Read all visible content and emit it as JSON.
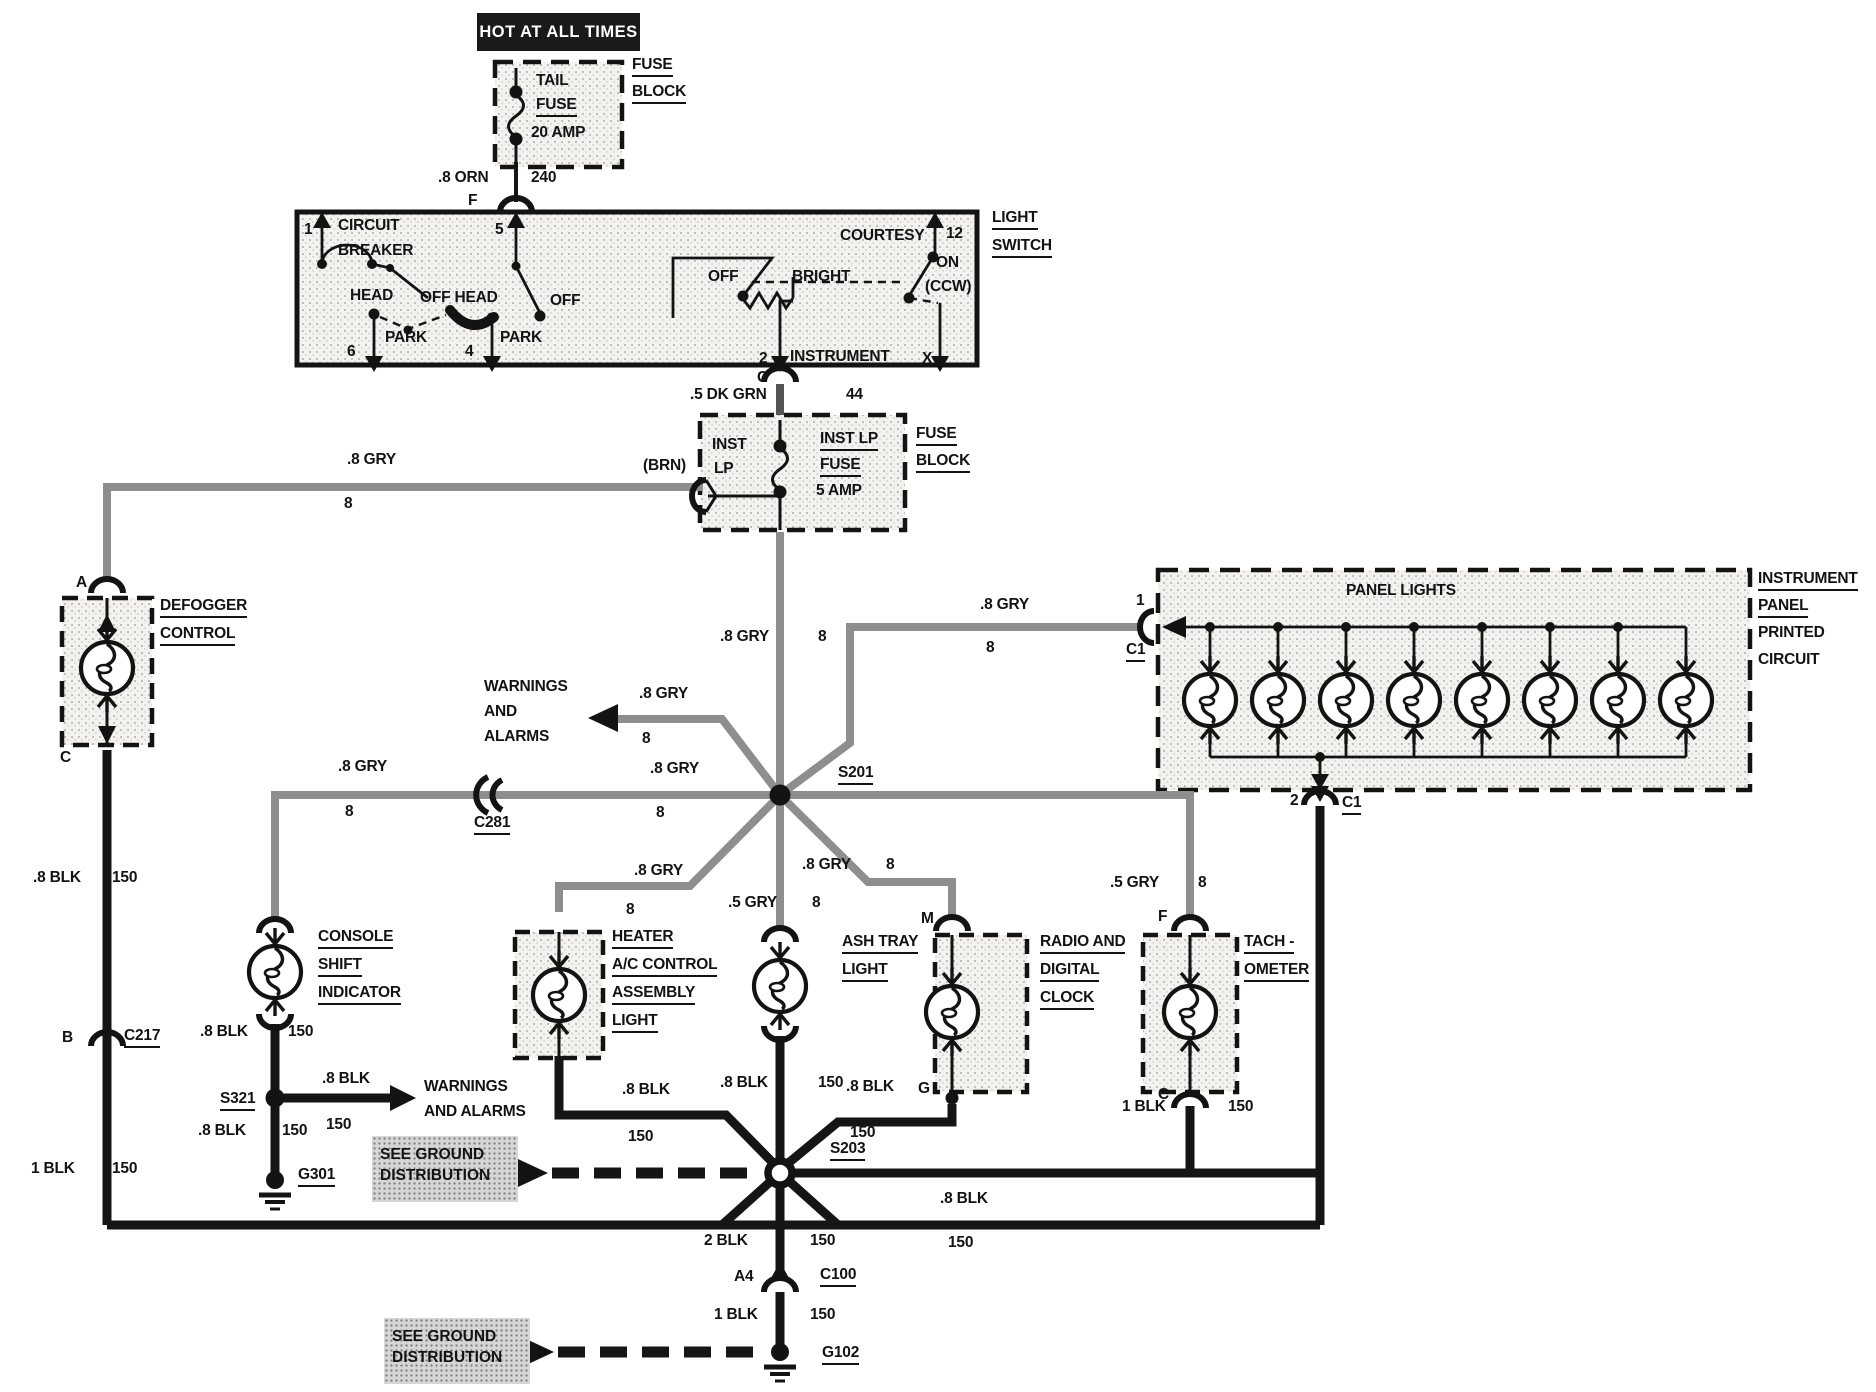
{
  "banner": {
    "text": "HOT AT ALL TIMES"
  },
  "see_ground_1": {
    "line1": "SEE GROUND",
    "line2": "DISTRIBUTION"
  },
  "see_ground_2": {
    "line1": "SEE GROUND",
    "line2": "DISTRIBUTION"
  },
  "labels": [
    {
      "name": "tail-fuse-name-1",
      "text": "TAIL",
      "x": 536,
      "y": 72,
      "u": false
    },
    {
      "name": "tail-fuse-name-2",
      "text": "FUSE",
      "x": 536,
      "y": 96,
      "u": true
    },
    {
      "name": "tail-fuse-rating",
      "text": "20 AMP",
      "x": 531,
      "y": 124,
      "u": false
    },
    {
      "name": "fuse-block-1-line1",
      "text": "FUSE",
      "x": 632,
      "y": 56,
      "u": true
    },
    {
      "name": "fuse-block-1-line2",
      "text": "BLOCK",
      "x": 632,
      "y": 83,
      "u": true
    },
    {
      "name": "wire-orn-gauge",
      "text": ".8 ORN",
      "x": 438,
      "y": 169,
      "u": false
    },
    {
      "name": "wire-orn-circuit",
      "text": "240",
      "x": 531,
      "y": 169,
      "u": false
    },
    {
      "name": "pin-f-lightswitch",
      "text": "F",
      "x": 468,
      "y": 192,
      "u": false
    },
    {
      "name": "ls-pin-1",
      "text": "1",
      "x": 304,
      "y": 221,
      "u": false
    },
    {
      "name": "ls-circuit-breaker-1",
      "text": "CIRCUIT",
      "x": 338,
      "y": 217,
      "u": false
    },
    {
      "name": "ls-circuit-breaker-2",
      "text": "BREAKER",
      "x": 338,
      "y": 242,
      "u": false
    },
    {
      "name": "ls-pin-5",
      "text": "5",
      "x": 495,
      "y": 221,
      "u": false
    },
    {
      "name": "ls-head",
      "text": "HEAD",
      "x": 350,
      "y": 287,
      "u": false
    },
    {
      "name": "ls-off-head",
      "text": "OFF HEAD",
      "x": 420,
      "y": 289,
      "u": false
    },
    {
      "name": "ls-off-left",
      "text": "OFF",
      "x": 550,
      "y": 292,
      "u": false
    },
    {
      "name": "ls-park-1",
      "text": "PARK",
      "x": 385,
      "y": 329,
      "u": false
    },
    {
      "name": "ls-park-2",
      "text": "PARK",
      "x": 500,
      "y": 329,
      "u": false
    },
    {
      "name": "ls-pin-6",
      "text": "6",
      "x": 347,
      "y": 343,
      "u": false
    },
    {
      "name": "ls-pin-4",
      "text": "4",
      "x": 465,
      "y": 343,
      "u": false
    },
    {
      "name": "ls-courtesy",
      "text": "COURTESY",
      "x": 840,
      "y": 227,
      "u": false
    },
    {
      "name": "ls-pin-12",
      "text": "12",
      "x": 946,
      "y": 225,
      "u": false
    },
    {
      "name": "ls-on",
      "text": "ON",
      "x": 936,
      "y": 254,
      "u": false
    },
    {
      "name": "ls-ccw",
      "text": "(CCW)",
      "x": 925,
      "y": 278,
      "u": false
    },
    {
      "name": "ls-off-right",
      "text": "OFF",
      "x": 708,
      "y": 268,
      "u": false
    },
    {
      "name": "ls-bright",
      "text": "BRIGHT",
      "x": 792,
      "y": 268,
      "u": false
    },
    {
      "name": "ls-pin-2",
      "text": "2",
      "x": 759,
      "y": 350,
      "u": false
    },
    {
      "name": "ls-instrument",
      "text": "INSTRUMENT",
      "x": 790,
      "y": 348,
      "u": false
    },
    {
      "name": "ls-pin-x",
      "text": "X",
      "x": 922,
      "y": 350,
      "u": false
    },
    {
      "name": "light-switch-label-1",
      "text": "LIGHT",
      "x": 992,
      "y": 209,
      "u": true
    },
    {
      "name": "light-switch-label-2",
      "text": "SWITCH",
      "x": 992,
      "y": 237,
      "u": true
    },
    {
      "name": "pin-c-lightswitch",
      "text": "C",
      "x": 757,
      "y": 369,
      "u": false
    },
    {
      "name": "wire-dkgrn-gauge",
      "text": ".5 DK GRN",
      "x": 690,
      "y": 386,
      "u": false
    },
    {
      "name": "wire-dkgrn-circuit",
      "text": "44",
      "x": 846,
      "y": 386,
      "u": false
    },
    {
      "name": "instlp-side-1",
      "text": "INST",
      "x": 712,
      "y": 436,
      "u": false
    },
    {
      "name": "instlp-side-2",
      "text": "LP",
      "x": 714,
      "y": 460,
      "u": false
    },
    {
      "name": "instlp-fuse-1",
      "text": "INST LP",
      "x": 820,
      "y": 430,
      "u": true
    },
    {
      "name": "instlp-fuse-2",
      "text": "FUSE",
      "x": 820,
      "y": 456,
      "u": true
    },
    {
      "name": "instlp-rating",
      "text": "5 AMP",
      "x": 816,
      "y": 482,
      "u": false
    },
    {
      "name": "fuse-block-2-line1",
      "text": "FUSE",
      "x": 916,
      "y": 425,
      "u": true
    },
    {
      "name": "fuse-block-2-line2",
      "text": "BLOCK",
      "x": 916,
      "y": 452,
      "u": true
    },
    {
      "name": "wire-brn",
      "text": "(BRN)",
      "x": 643,
      "y": 457,
      "u": false
    },
    {
      "name": "wire-gry-top",
      "text": ".8 GRY",
      "x": 347,
      "y": 451,
      "u": false
    },
    {
      "name": "wire-gry-top-circuit",
      "text": "8",
      "x": 344,
      "y": 495,
      "u": false
    },
    {
      "name": "pin-a-defogger",
      "text": "A",
      "x": 76,
      "y": 574,
      "u": false
    },
    {
      "name": "defogger-label-1",
      "text": "DEFOGGER",
      "x": 160,
      "y": 597,
      "u": true
    },
    {
      "name": "defogger-label-2",
      "text": "CONTROL",
      "x": 160,
      "y": 625,
      "u": true
    },
    {
      "name": "pin-c-defogger",
      "text": "C",
      "x": 60,
      "y": 749,
      "u": false
    },
    {
      "name": "wire-blk-defog",
      "text": ".8 BLK",
      "x": 33,
      "y": 869,
      "u": false
    },
    {
      "name": "wire-blk-defog-circuit",
      "text": "150",
      "x": 112,
      "y": 869,
      "u": false
    },
    {
      "name": "pin-b-c217",
      "text": "B",
      "x": 62,
      "y": 1029,
      "u": false
    },
    {
      "name": "conn-c217",
      "text": "C217",
      "x": 124,
      "y": 1027,
      "u": true
    },
    {
      "name": "wire-1blk-defog",
      "text": "1 BLK",
      "x": 31,
      "y": 1160,
      "u": false
    },
    {
      "name": "wire-1blk-defog-circuit",
      "text": "150",
      "x": 112,
      "y": 1160,
      "u": false
    },
    {
      "name": "splice-s201",
      "text": "S201",
      "x": 838,
      "y": 764,
      "u": true
    },
    {
      "name": "wire-gry-n",
      "text": ".8 GRY",
      "x": 720,
      "y": 628,
      "u": false
    },
    {
      "name": "wire-gry-n-circuit",
      "text": "8",
      "x": 818,
      "y": 628,
      "u": false
    },
    {
      "name": "wire-gry-ne",
      "text": ".8 GRY",
      "x": 980,
      "y": 596,
      "u": false
    },
    {
      "name": "wire-gry-ne-circuit",
      "text": "8",
      "x": 986,
      "y": 639,
      "u": false
    },
    {
      "name": "pin-1-panel",
      "text": "1",
      "x": 1136,
      "y": 592,
      "u": false
    },
    {
      "name": "conn-c1-top",
      "text": "C1",
      "x": 1126,
      "y": 641,
      "u": true
    },
    {
      "name": "wire-gry-w-right",
      "text": ".8 GRY",
      "x": 650,
      "y": 760,
      "u": false
    },
    {
      "name": "wire-gry-w-right-circuit",
      "text": "8",
      "x": 656,
      "y": 804,
      "u": false
    },
    {
      "name": "conn-c281",
      "text": "C281",
      "x": 474,
      "y": 814,
      "u": true
    },
    {
      "name": "wire-gry-w-left",
      "text": ".8 GRY",
      "x": 338,
      "y": 758,
      "u": false
    },
    {
      "name": "wire-gry-w-left-circuit",
      "text": "8",
      "x": 345,
      "y": 803,
      "u": false
    },
    {
      "name": "warnings-1-line1",
      "text": "WARNINGS",
      "x": 484,
      "y": 678,
      "u": false
    },
    {
      "name": "warnings-1-line2",
      "text": "AND",
      "x": 484,
      "y": 703,
      "u": false
    },
    {
      "name": "warnings-1-line3",
      "text": "ALARMS",
      "x": 484,
      "y": 728,
      "u": false
    },
    {
      "name": "wire-gry-nw",
      "text": ".8 GRY",
      "x": 639,
      "y": 685,
      "u": false
    },
    {
      "name": "wire-gry-nw-circuit",
      "text": "8",
      "x": 642,
      "y": 730,
      "u": false
    },
    {
      "name": "wire-gry-sw",
      "text": ".8 GRY",
      "x": 634,
      "y": 862,
      "u": false
    },
    {
      "name": "wire-gry-sw-circuit",
      "text": "8",
      "x": 626,
      "y": 901,
      "u": false
    },
    {
      "name": "wire-gry-s",
      "text": ".5 GRY",
      "x": 728,
      "y": 894,
      "u": false
    },
    {
      "name": "wire-gry-s-circuit",
      "text": "8",
      "x": 812,
      "y": 894,
      "u": false
    },
    {
      "name": "wire-gry-se",
      "text": ".8 GRY",
      "x": 802,
      "y": 856,
      "u": false
    },
    {
      "name": "wire-gry-se-circuit",
      "text": "8",
      "x": 886,
      "y": 856,
      "u": false
    },
    {
      "name": "wire-gry-e",
      "text": ".5 GRY",
      "x": 1110,
      "y": 874,
      "u": false
    },
    {
      "name": "wire-gry-e-circuit",
      "text": "8",
      "x": 1198,
      "y": 874,
      "u": false
    },
    {
      "name": "console-label-1",
      "text": "CONSOLE",
      "x": 318,
      "y": 928,
      "u": true
    },
    {
      "name": "console-label-2",
      "text": "SHIFT",
      "x": 318,
      "y": 956,
      "u": true
    },
    {
      "name": "console-label-3",
      "text": "INDICATOR",
      "x": 318,
      "y": 984,
      "u": true
    },
    {
      "name": "wire-blk-console",
      "text": ".8 BLK",
      "x": 200,
      "y": 1023,
      "u": false
    },
    {
      "name": "wire-blk-console-circuit",
      "text": "150",
      "x": 288,
      "y": 1023,
      "u": false
    },
    {
      "name": "splice-s321",
      "text": "S321",
      "x": 220,
      "y": 1090,
      "u": true
    },
    {
      "name": "wire-blk-console2",
      "text": ".8 BLK",
      "x": 198,
      "y": 1122,
      "u": false
    },
    {
      "name": "wire-blk-console2-circuit",
      "text": "150",
      "x": 282,
      "y": 1122,
      "u": false
    },
    {
      "name": "wire-blk-warn",
      "text": ".8 BLK",
      "x": 322,
      "y": 1070,
      "u": false
    },
    {
      "name": "wire-blk-warn-circuit",
      "text": "150",
      "x": 326,
      "y": 1116,
      "u": false
    },
    {
      "name": "warnings-2-line1",
      "text": "WARNINGS",
      "x": 424,
      "y": 1078,
      "u": false
    },
    {
      "name": "warnings-2-line2",
      "text": "AND ALARMS",
      "x": 424,
      "y": 1103,
      "u": false
    },
    {
      "name": "ground-g301",
      "text": "G301",
      "x": 298,
      "y": 1166,
      "u": true
    },
    {
      "name": "heater-label-1",
      "text": "HEATER",
      "x": 612,
      "y": 928,
      "u": true
    },
    {
      "name": "heater-label-2",
      "text": "A/C CONTROL",
      "x": 612,
      "y": 956,
      "u": true
    },
    {
      "name": "heater-label-3",
      "text": "ASSEMBLY",
      "x": 612,
      "y": 984,
      "u": true
    },
    {
      "name": "heater-label-4",
      "text": "LIGHT",
      "x": 612,
      "y": 1012,
      "u": true
    },
    {
      "name": "wire-blk-heater",
      "text": ".8 BLK",
      "x": 622,
      "y": 1081,
      "u": false
    },
    {
      "name": "wire-blk-heater-circuit",
      "text": "150",
      "x": 628,
      "y": 1128,
      "u": false
    },
    {
      "name": "ashtray-label-1",
      "text": "ASH TRAY",
      "x": 842,
      "y": 933,
      "u": true
    },
    {
      "name": "ashtray-label-2",
      "text": "LIGHT",
      "x": 842,
      "y": 961,
      "u": true
    },
    {
      "name": "wire-blk-ash",
      "text": ".8 BLK",
      "x": 720,
      "y": 1074,
      "u": false
    },
    {
      "name": "wire-blk-ash-circuit",
      "text": "150",
      "x": 818,
      "y": 1074,
      "u": false
    },
    {
      "name": "pin-m-radio",
      "text": "M",
      "x": 921,
      "y": 910,
      "u": false
    },
    {
      "name": "radio-label-1",
      "text": "RADIO AND",
      "x": 1040,
      "y": 933,
      "u": true
    },
    {
      "name": "radio-label-2",
      "text": "DIGITAL",
      "x": 1040,
      "y": 961,
      "u": true
    },
    {
      "name": "radio-label-3",
      "text": "CLOCK",
      "x": 1040,
      "y": 989,
      "u": true
    },
    {
      "name": "pin-g-radio",
      "text": "G",
      "x": 918,
      "y": 1080,
      "u": false
    },
    {
      "name": "wire-blk-radio",
      "text": ".8 BLK",
      "x": 846,
      "y": 1078,
      "u": false
    },
    {
      "name": "wire-blk-radio-circuit",
      "text": "150",
      "x": 850,
      "y": 1124,
      "u": false
    },
    {
      "name": "pin-f-tach",
      "text": "F",
      "x": 1158,
      "y": 908,
      "u": false
    },
    {
      "name": "tach-label-1",
      "text": "TACH -",
      "x": 1244,
      "y": 933,
      "u": true
    },
    {
      "name": "tach-label-2",
      "text": "OMETER",
      "x": 1244,
      "y": 961,
      "u": true
    },
    {
      "name": "pin-c-tach",
      "text": "C",
      "x": 1158,
      "y": 1086,
      "u": false
    },
    {
      "name": "wire-1blk-tach",
      "text": "1 BLK",
      "x": 1122,
      "y": 1098,
      "u": false
    },
    {
      "name": "wire-1blk-tach-circuit",
      "text": "150",
      "x": 1228,
      "y": 1098,
      "u": false
    },
    {
      "name": "panel-lights-title",
      "text": "PANEL LIGHTS",
      "x": 1346,
      "y": 582,
      "u": false
    },
    {
      "name": "instr-panel-1",
      "text": "INSTRUMENT",
      "x": 1758,
      "y": 570,
      "u": true
    },
    {
      "name": "instr-panel-2",
      "text": "PANEL",
      "x": 1758,
      "y": 597,
      "u": true
    },
    {
      "name": "instr-panel-3",
      "text": "PRINTED",
      "x": 1758,
      "y": 624,
      "u": false
    },
    {
      "name": "instr-panel-4",
      "text": "CIRCUIT",
      "x": 1758,
      "y": 651,
      "u": false
    },
    {
      "name": "pin-2-panel",
      "text": "2",
      "x": 1290,
      "y": 792,
      "u": false
    },
    {
      "name": "conn-c1-bottom",
      "text": "C1",
      "x": 1342,
      "y": 794,
      "u": true
    },
    {
      "name": "splice-s203",
      "text": "S203",
      "x": 830,
      "y": 1140,
      "u": true
    },
    {
      "name": "wire-blk-bottom-r",
      "text": ".8 BLK",
      "x": 940,
      "y": 1190,
      "u": false
    },
    {
      "name": "wire-blk-bottom-r-circuit",
      "text": "150",
      "x": 948,
      "y": 1234,
      "u": false
    },
    {
      "name": "wire-2blk",
      "text": "2 BLK",
      "x": 704,
      "y": 1232,
      "u": false
    },
    {
      "name": "wire-2blk-circuit",
      "text": "150",
      "x": 810,
      "y": 1232,
      "u": false
    },
    {
      "name": "pin-a4",
      "text": "A4",
      "x": 734,
      "y": 1268,
      "u": false
    },
    {
      "name": "conn-c100",
      "text": "C100",
      "x": 820,
      "y": 1266,
      "u": true
    },
    {
      "name": "wire-1blk-bottom",
      "text": "1 BLK",
      "x": 714,
      "y": 1306,
      "u": false
    },
    {
      "name": "wire-1blk-bottom-circuit",
      "text": "150",
      "x": 810,
      "y": 1306,
      "u": false
    },
    {
      "name": "ground-g102",
      "text": "G102",
      "x": 822,
      "y": 1344,
      "u": true
    }
  ]
}
